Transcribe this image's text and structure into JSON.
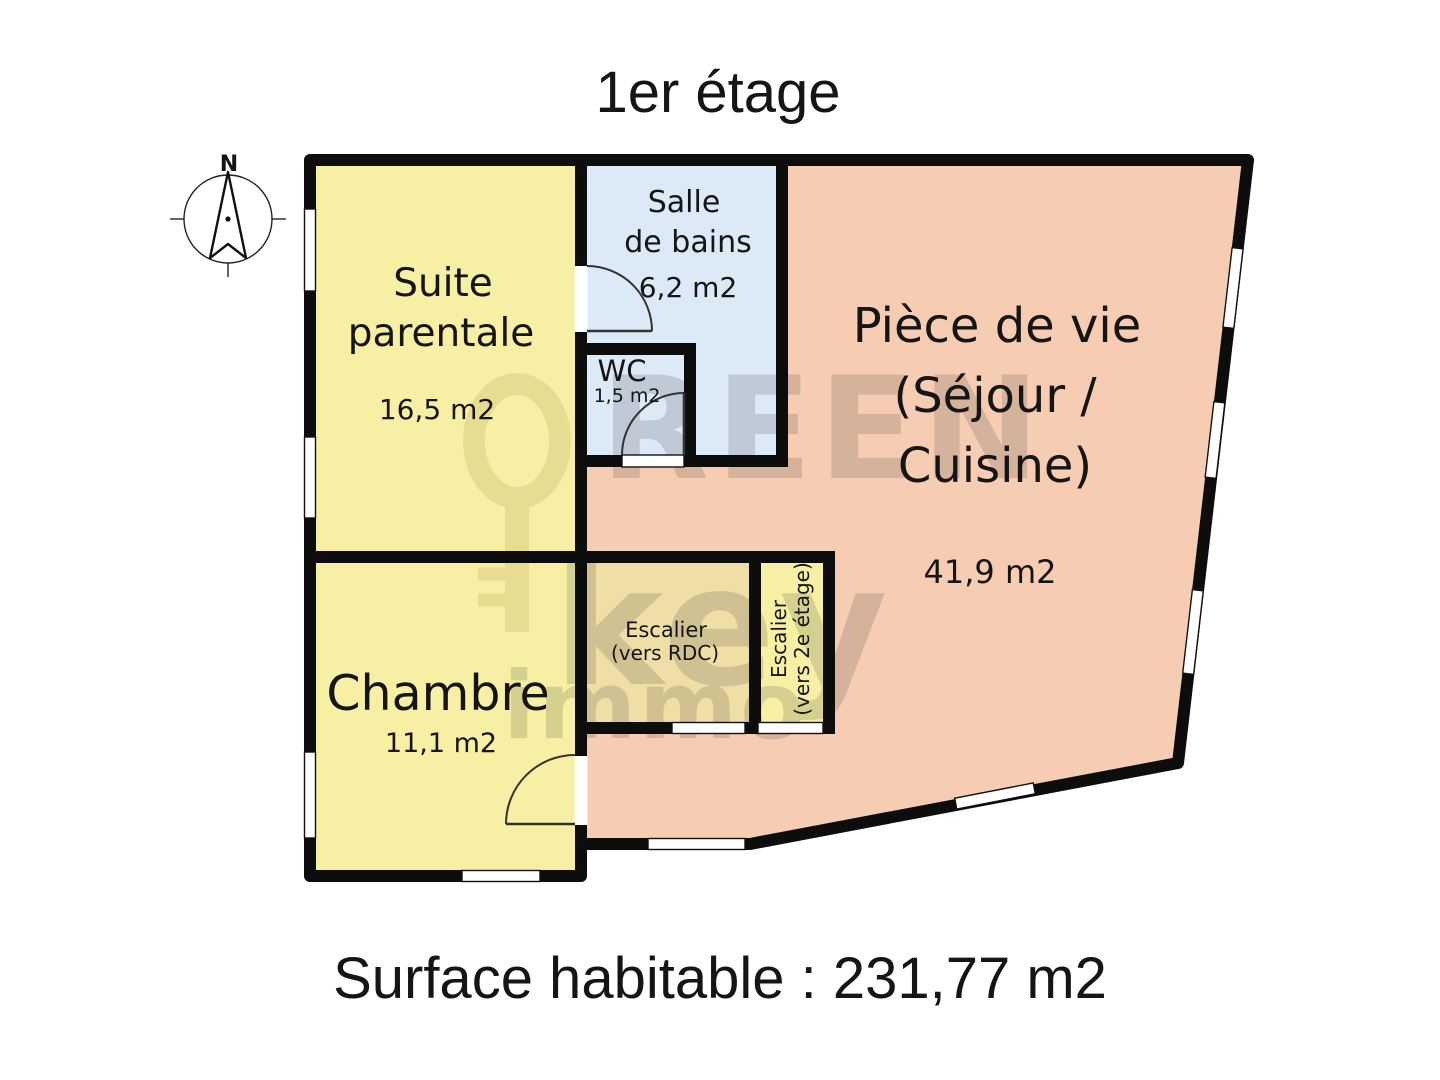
{
  "title": "1er étage",
  "footer": "Surface habitable : 231,77 m2",
  "compass": {
    "north_label": "N"
  },
  "colors": {
    "wall": "#0d0d0d",
    "room_yellow": "#f7f0a4",
    "room_blue": "#dce9f7",
    "room_pink": "#f6cdb2",
    "room_tan": "#efdfa6",
    "window_white": "#ffffff"
  },
  "rooms": {
    "suite_parentale": {
      "line1": "Suite",
      "line2": "parentale",
      "area": "16,5 m2"
    },
    "salle_de_bains": {
      "line1": "Salle",
      "line2": "de bains",
      "area": "6,2 m2"
    },
    "wc": {
      "name": "WC",
      "area": "1,5 m2"
    },
    "piece_de_vie": {
      "line1": "Pièce de vie",
      "line2": "(Séjour /",
      "line3": "Cuisine)",
      "area": "41,9 m2"
    },
    "chambre": {
      "name": "Chambre",
      "area": "11,1 m2"
    },
    "escalier_rdc": {
      "line1": "Escalier",
      "line2": "(vers RDC)"
    },
    "escalier_2e": {
      "line1": "Escalier",
      "line2": "(vers 2e étage)"
    }
  },
  "watermark": {
    "word1": "REEN",
    "word2": "key",
    "word3": "immo"
  }
}
